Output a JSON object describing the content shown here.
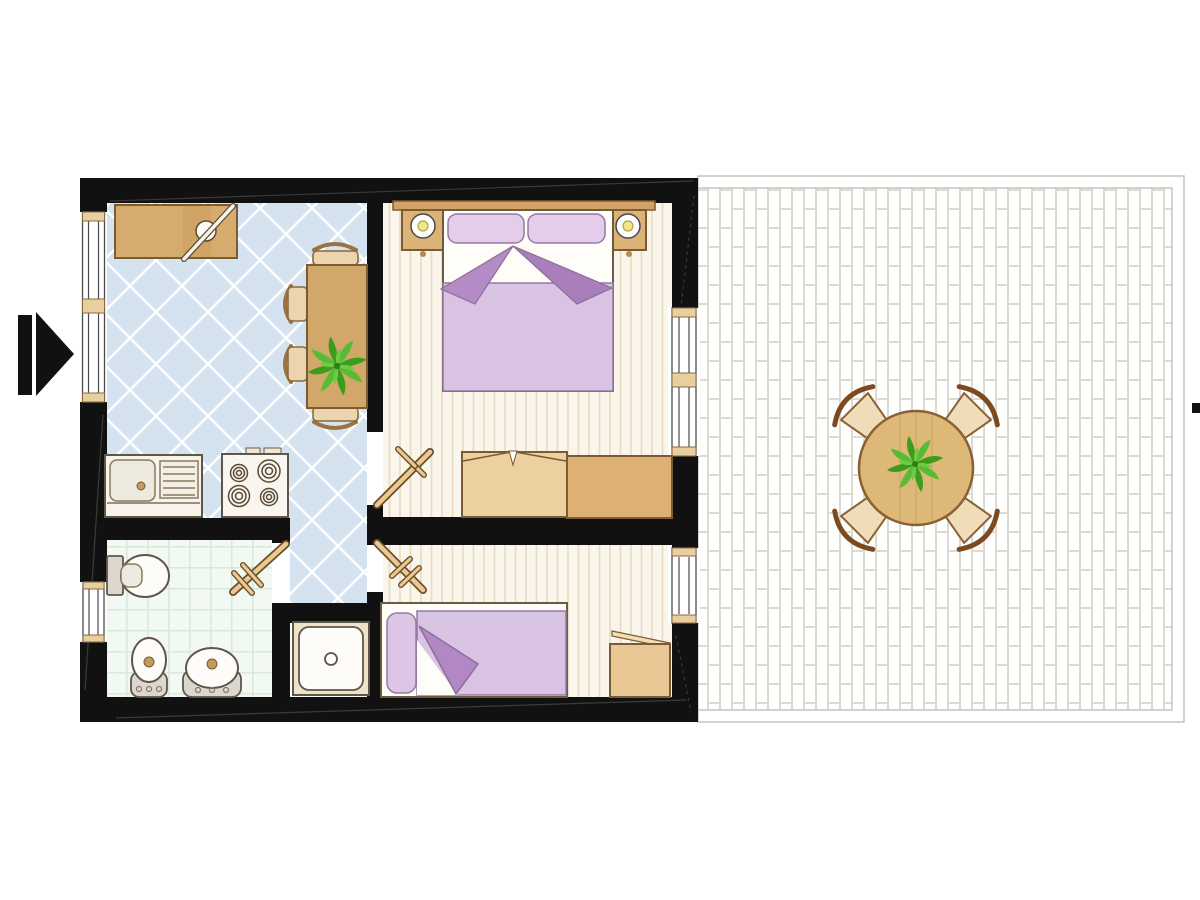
{
  "palette": {
    "wall": "#111111",
    "kitchen_tile": "#d5e3f0",
    "kitchen_tile_line": "#ffffff",
    "bath_tile": "#f2f9f3",
    "bath_tile_line": "#d8e8db",
    "bedroom_floor": "#fbf6ec",
    "bedroom_stripe": "#e9dcc4",
    "terrace_base": "#fdfdfa",
    "terrace_brick_line": "#dcdad2",
    "wood_mid": "#d2a76a",
    "wood_light": "#ecd5ae",
    "wood_dark": "#ddb173",
    "bedding_lavender": "#d9c3e2",
    "bedding_fold_dark": "#b48bc5",
    "pillow_lavender": "#e4cdea",
    "plant_green": "#3c9c1c",
    "lamp_yellow": "#f0e68c",
    "fixture_gray": "#dbd7cf",
    "fixture_white": "#fdfcf8",
    "door_leaf_tan": "#ecc892",
    "drain_tan": "#c59a5e"
  },
  "floor_plan": {
    "entry": {
      "arrow": "entry-arrow-pointing-right"
    },
    "rooms": {
      "kitchen": {
        "name": "kitchen-dining",
        "floor": "blue-diagonal-tiles",
        "furniture": [
          "counter-desk-with-board",
          "dining-table",
          "four-chairs",
          "potted-plant",
          "sink-unit-with-drainer",
          "stove-four-burners"
        ]
      },
      "master_bedroom": {
        "name": "master-bedroom",
        "floor": "wood-plank-strips",
        "furniture": [
          "double-bed",
          "two-pillows",
          "nightstand-lamp-left",
          "nightstand-lamp-right",
          "wardrobe-two-sections"
        ]
      },
      "bathroom": {
        "name": "bathroom",
        "floor": "mint-grid-tiles",
        "furniture": [
          "toilet",
          "bidet",
          "washbasin"
        ]
      },
      "hallway": {
        "name": "hallway",
        "floor": "blue-diagonal-tiles",
        "furniture": [
          "shower-tray"
        ]
      },
      "second_bedroom": {
        "name": "second-bedroom",
        "floor": "wood-plank-strips",
        "furniture": [
          "single-bed",
          "pillow",
          "side-cabinet"
        ]
      },
      "terrace": {
        "name": "terrace",
        "floor": "white-brick-paving",
        "furniture": [
          "round-table",
          "potted-plant",
          "four-chairs"
        ]
      }
    },
    "openings": {
      "interior_doors": 3,
      "entry_opening": 1,
      "windows_left_wall": 2,
      "windows_right_wall": 2
    }
  }
}
